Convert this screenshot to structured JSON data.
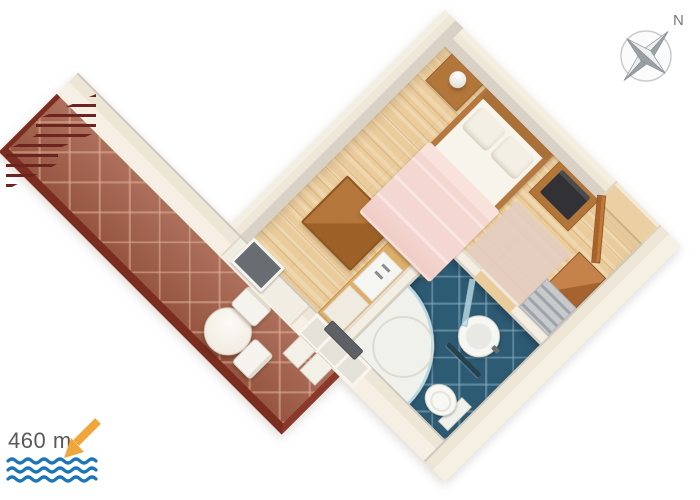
{
  "compass": {
    "label": "N"
  },
  "distance": {
    "label": "460 m"
  },
  "palette": {
    "wall_cream": "#EFE7D8",
    "wall_shadow": "#D8D1C6",
    "wood_floor": "#EACC9C",
    "terrace_tile": "#A5614B",
    "terrace_edge": "#7B2D20",
    "railing_dark_red": "#6B2420",
    "bathroom_tile": "#2E5B74",
    "bed_blanket_pink": "#F5D7D1",
    "linen_white": "#F7F4EC",
    "wood_furniture": "#B2763B",
    "entrance_door": "#A9632A",
    "wave_blue": "#1C75BB",
    "arrow_orange": "#F0A63B",
    "compass_gray": "#9BA0A4",
    "label_gray": "#58595B"
  },
  "scene": {
    "view": "isometric 3D floor plan, rotated 45 degrees",
    "rooms": [
      {
        "name": "terrace",
        "floor": "red-brown diamond tiles",
        "furniture": [
          "round table",
          "chair",
          "chair"
        ],
        "features": [
          "dark red railing"
        ]
      },
      {
        "name": "bedroom",
        "floor": "light wood planks",
        "furniture": [
          "double bed with pink blanket and two pillows",
          "nightstand with lamp",
          "tv stand with tv",
          "wooden table",
          "wooden chair",
          "pink rug",
          "kitchenette counter with hob and sink",
          "balcony glass door",
          "window"
        ]
      },
      {
        "name": "hallway",
        "floor": "light wood planks",
        "furniture": [
          "wardrobe",
          "gray shelf unit"
        ],
        "features": [
          "entrance door ajar"
        ]
      },
      {
        "name": "bathroom",
        "floor": "dark blue diamond tiles",
        "fixtures": [
          "corner shower with curved glass",
          "round washbasin with tap",
          "toilet",
          "towel rail",
          "glass door"
        ]
      }
    ]
  }
}
